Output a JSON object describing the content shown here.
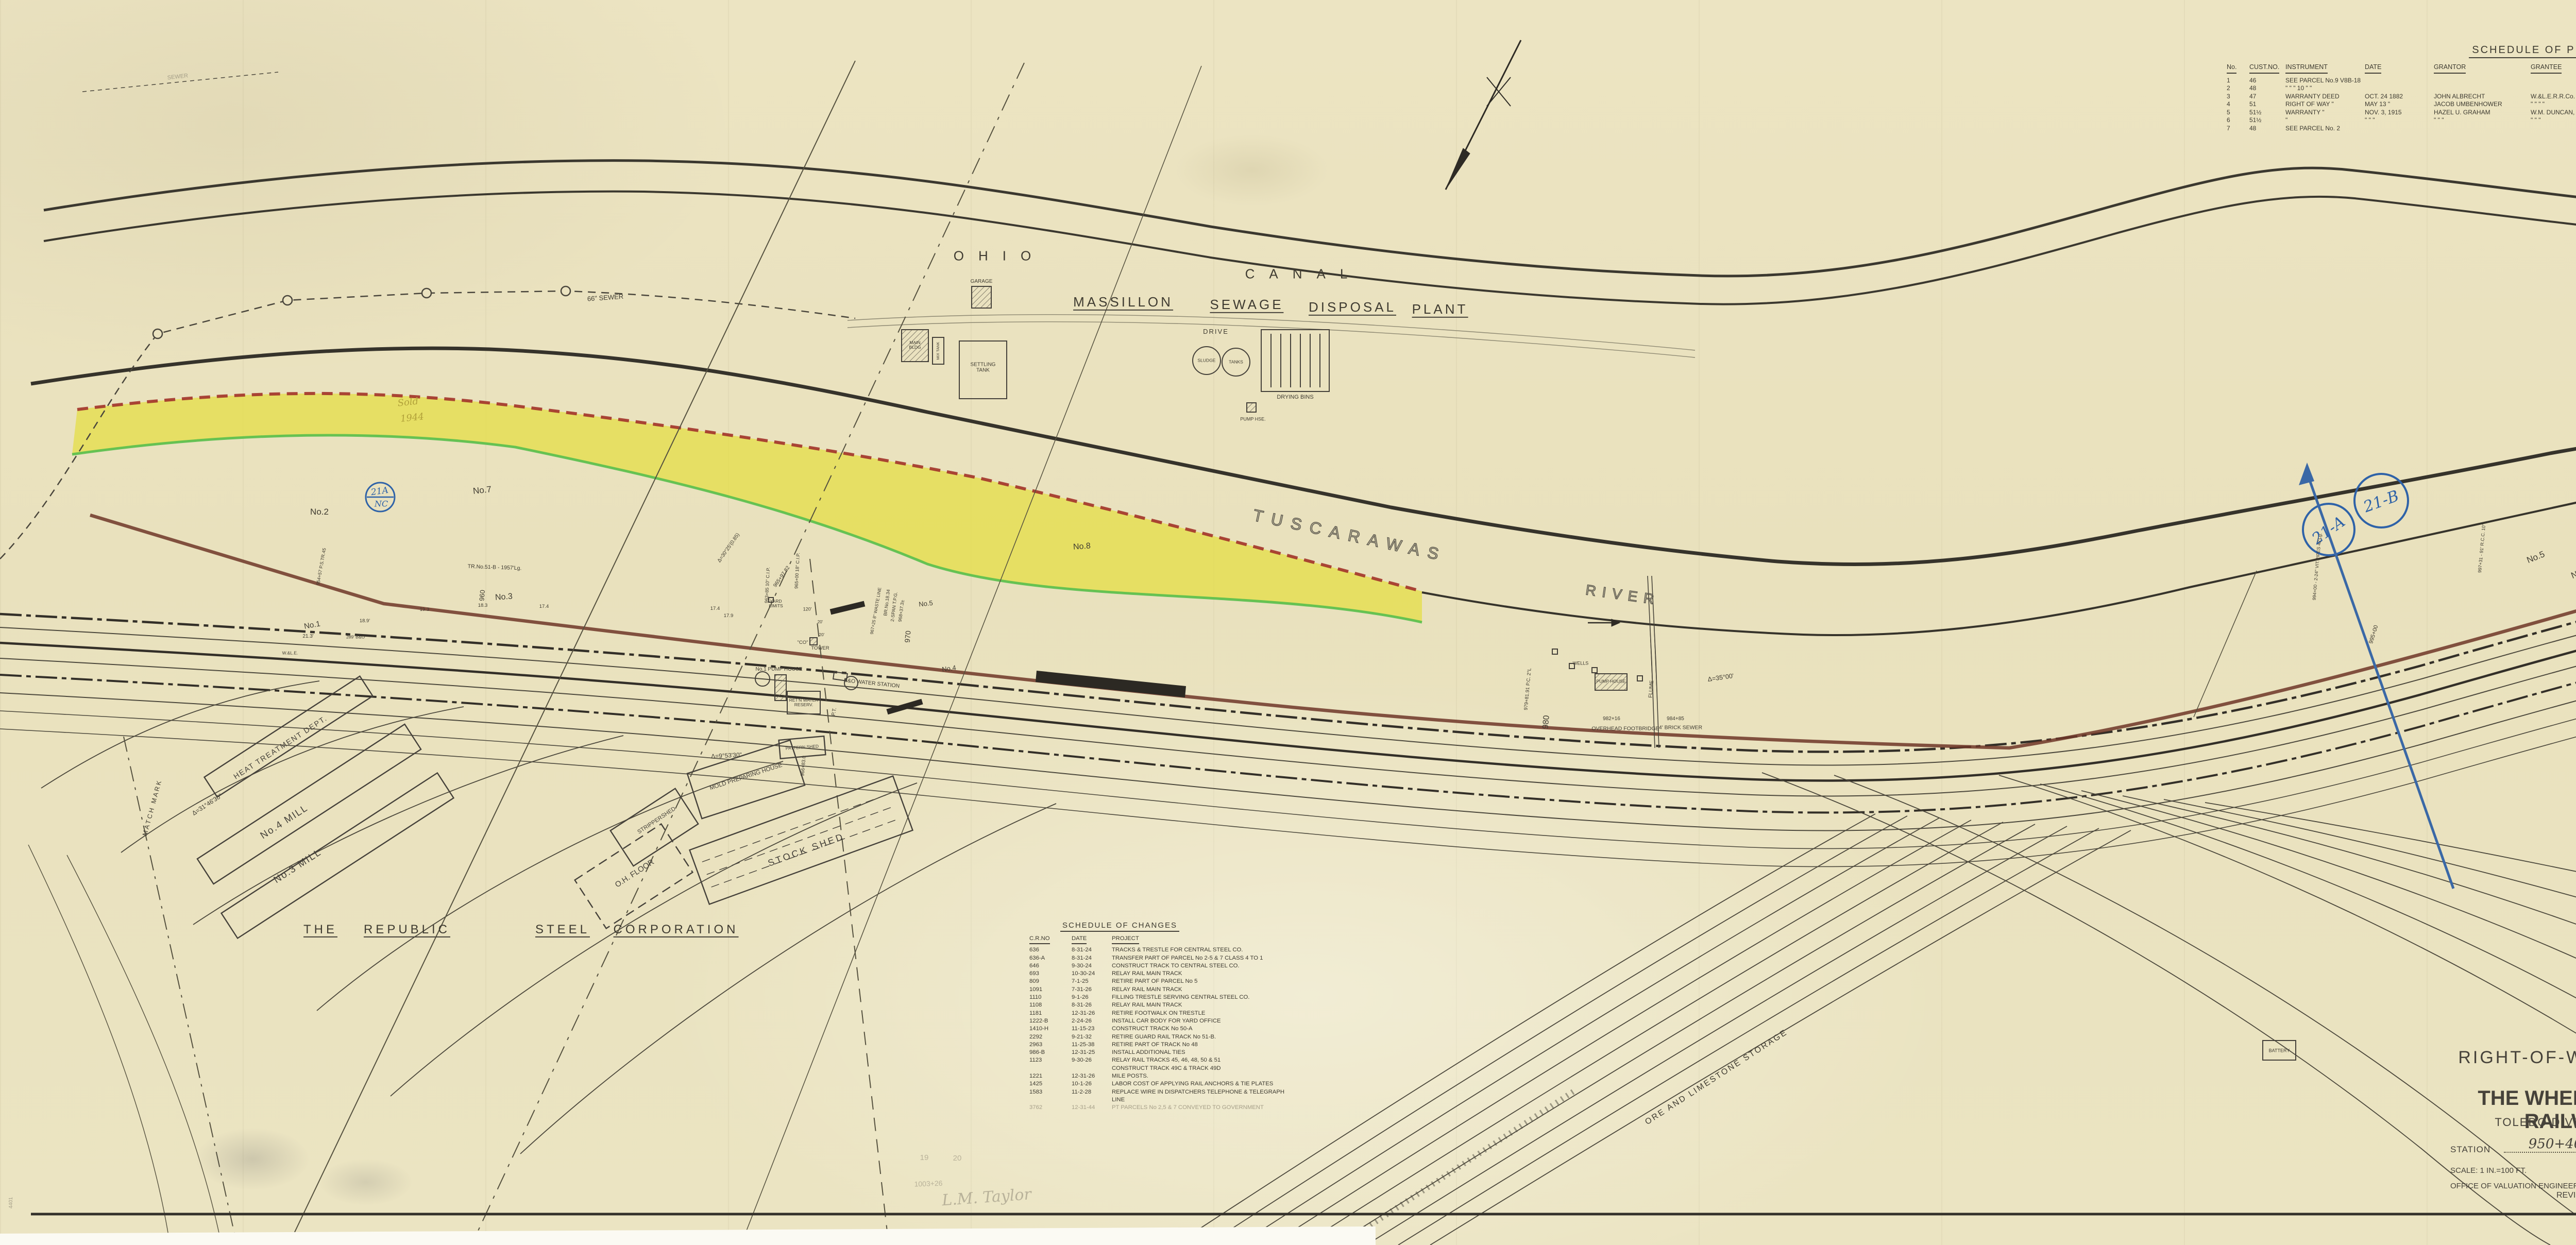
{
  "title_block": {
    "map_type": "RIGHT-OF-WAY AND TRACK MAP",
    "company": "THE WHEELING & LAKE ERIE RAILWAY COMPANY",
    "division": "TOLEDO DIVISION - MASSILLON BRANCH",
    "station_label": "STATION",
    "station_from": "950+40",
    "to_station_label": "TO STATION",
    "station_to": "1003+20",
    "scale": "SCALE:  1 IN.=100 FT.",
    "date": "JUNE 30, 1918",
    "office": "OFFICE OF VALUATION ENGINEER,",
    "office_city": "CLEVELAND, O.",
    "revised_label": "REVISED DECEMBER 31,",
    "revised_year": "1940",
    "revised_ditto": "\"",
    "revised_year2": "1941",
    "revision_note": "Rev 4/1954",
    "stamp_top": "V.8B",
    "stamp_bottom": "19"
  },
  "property_schedule": {
    "title": "SCHEDULE OF PROPERTY",
    "headers": [
      "No.",
      "CUST.NO.",
      "INSTRUMENT",
      "DATE",
      "GRANTOR",
      "GRANTEE",
      "RECORD",
      "REMARKS"
    ],
    "rows": [
      {
        "no": "1",
        "cust": "46",
        "instrument": "SEE PARCEL No.9  V8B-18",
        "date": "",
        "grantor": "",
        "grantee": "",
        "record": "",
        "remarks": ""
      },
      {
        "no": "2",
        "cust": "48",
        "instrument": "\"    \"    \" 10   \"    \"",
        "date": "",
        "grantor": "",
        "grantee": "",
        "record": "",
        "remarks": ""
      },
      {
        "no": "3",
        "cust": "47",
        "instrument": "WARRANTY DEED",
        "date": "OCT. 24 1882",
        "grantor": "JOHN ALBRECHT",
        "grantee": "W.&L.E.R.R.Co.",
        "record": "D.B.183, P.362 JAN.13, 1883",
        "remarks": ""
      },
      {
        "no": "4",
        "cust": "51",
        "instrument": "RIGHT OF WAY  \"",
        "date": "MAY 13  \"",
        "grantor": "JACOB UMBENHOWER",
        "grantee": "\"   \"   \"   \"",
        "record": "\"  \"  \" 369  \" 15  \"",
        "remarks": ""
      },
      {
        "no": "5",
        "cust": "51½",
        "instrument": "WARRANTY  \"",
        "date": "NOV. 3, 1915",
        "grantor": "HAZEL U. GRAHAM",
        "grantee": "W.M. DUNCAN, RECEIVER",
        "record": "\" 586 \" 335 NOV. 22 1915",
        "remarks": "NOT IN USE  PT. CONV'Y'D TO U.S. GOV'T"
      },
      {
        "no": "6",
        "cust": "51½",
        "instrument": "\"",
        "date": "\"   \"   \"",
        "grantor": "\"   \"   \"",
        "grantee": "\"   \"   \"",
        "record": "\"  \"  \"  \"  \"  \"",
        "remarks": "\"  \"  \""
      },
      {
        "no": "7",
        "cust": "48",
        "instrument": "SEE PARCEL No. 2",
        "date": "",
        "grantor": "",
        "grantee": "",
        "record": "",
        "remarks": ""
      }
    ]
  },
  "changes_schedule": {
    "title": "SCHEDULE OF CHANGES",
    "headers": [
      "C.R.NO",
      "DATE",
      "PROJECT"
    ],
    "rows": [
      {
        "cr": "636",
        "date": "8-31-24",
        "project": "TRACKS & TRESTLE FOR CENTRAL STEEL CO."
      },
      {
        "cr": "636-A",
        "date": "8-31-24",
        "project": "TRANSFER PART OF PARCEL No 2-5 & 7 CLASS 4 TO 1"
      },
      {
        "cr": "646",
        "date": "9-30-24",
        "project": "CONSTRUCT TRACK TO CENTRAL STEEL CO."
      },
      {
        "cr": "693",
        "date": "10-30-24",
        "project": "RELAY RAIL MAIN TRACK"
      },
      {
        "cr": "809",
        "date": "7-1-25",
        "project": "RETIRE PART OF PARCEL No 5"
      },
      {
        "cr": "1091",
        "date": "7-31-26",
        "project": "RELAY RAIL MAIN TRACK"
      },
      {
        "cr": "1110",
        "date": "9-1-26",
        "project": "FILLING TRESTLE SERVING CENTRAL STEEL CO."
      },
      {
        "cr": "1108",
        "date": "8-31-26",
        "project": "RELAY RAIL MAIN TRACK"
      },
      {
        "cr": "1181",
        "date": "12-31-26",
        "project": "RETIRE FOOTWALK ON TRESTLE"
      },
      {
        "cr": "1222-B",
        "date": "2-24-26",
        "project": "INSTALL CAR BODY FOR YARD OFFICE"
      },
      {
        "cr": "1410-H",
        "date": "11-15-23",
        "project": "CONSTRUCT TRACK No 50-A"
      },
      {
        "cr": "2292",
        "date": "9-21-32",
        "project": "RETIRE GUARD RAIL TRACK No 51-B."
      },
      {
        "cr": "2963",
        "date": "11-25-38",
        "project": "RETIRE PART OF TRACK No 48"
      },
      {
        "cr": "986-B",
        "date": "12-31-25",
        "project": "INSTALL ADDITIONAL TIES"
      },
      {
        "cr": "1123",
        "date": "9-30-26",
        "project": "RELAY RAIL TRACKS 45, 46, 48, 50 & 51"
      },
      {
        "cr": "",
        "date": "",
        "project": "CONSTRUCT TRACK 49C & TRACK 49D"
      },
      {
        "cr": "1221",
        "date": "12-31-26",
        "project": "MILE POSTS."
      },
      {
        "cr": "1425",
        "date": "10-1-26",
        "project": "LABOR COST OF APPLYING RAIL ANCHORS & TIE PLATES"
      },
      {
        "cr": "1583",
        "date": "11-2-28",
        "project": "REPLACE WIRE IN DISPATCHERS TELEPHONE & TELEGRAPH LINE"
      },
      {
        "cr": "3762",
        "date": "12-31-44",
        "project": "PT PARCELS No 2,5 & 7 CONVEYED TO GOVERNMENT"
      }
    ]
  },
  "map": {
    "ohio": "OHIO",
    "canal": "CANAL",
    "msp1": "MASSILLON",
    "msp2": "SEWAGE",
    "msp3": "DISPOSAL",
    "msp4": "PLANT",
    "drive": "DRIVE",
    "sewer66": "66\" SEWER",
    "sewer_small": "SEWER",
    "garage": "GARAGE",
    "main_bldg": "MAIN BLDG",
    "mix_tank": "MIX TANK",
    "settling_tank": "SETTLING TANK",
    "sludge": "SLUDGE",
    "tanks": "TANKS",
    "drying_bins": "DRYING BINS",
    "pump_hse": "PUMP HSE.",
    "wells": "WELLS",
    "pump_house": "PUMP HOUSE",
    "flume": "FLUME",
    "footbridge_sta": "982+16",
    "footbridge": "OVERHEAD FOOTBRIDGE",
    "brick_sewer_sta": "984+85",
    "brick_sewer": "4' BRICK SEWER",
    "sta980": "980",
    "pc979": "979+81.91  P.C. 2°L",
    "delta35": "Δ=35°00'",
    "tuscarawas": "TUSCARAWAS",
    "river": "RIVER",
    "sold1": "Sold",
    "sold2": "1944",
    "no1": "No.1",
    "no2": "No.2",
    "no3": "No.3",
    "no7": "No.7",
    "no8": "No.8",
    "no4r": "No.4",
    "no5r": "No.5",
    "no6r": "No.6",
    "no4l": "No.4",
    "no5l": "No.5",
    "tr51b": "TR.No.51-B - 1957'Lg.",
    "m213": "21.3'",
    "m189": "18.9'",
    "m193": "19.3",
    "m183": "18.3",
    "m174a": "17.4",
    "m174b": "17.4",
    "m179": "17.9",
    "sta954": "954+57  P.S.TR.45",
    "b289": "289' B&O",
    "wle": "W.&L.E.",
    "sta960": "960",
    "yard_limits": "YARD LIMITS",
    "co": "\"CO\"",
    "tower": "TOWER",
    "f120": "120'",
    "f20a": "20'",
    "f20b": "20'",
    "pump1": "No.1 PUMP HOUSE",
    "retn": "RET'N WATER RESERV.",
    "bo_water": "B&O WATER STATION",
    "br1834a": "BR.No.18.34",
    "br1834b": "2-SPAN T.P.G.",
    "br1834c": "968+37.3±",
    "sta970": "970",
    "cip963": "963+85  10\" C.I.P.",
    "cip965": "965+00  18\" C.I.P.",
    "sta96597": "965+97.82",
    "delta3025": "Δ=30°25'(0.85)",
    "waste967": "967+25  8\" WASTE LINE",
    "pt": "P.T.",
    "delta953": "Δ=9°53'30\"",
    "sta96683": "966+83.0",
    "delta3146": "Δ=31°46'30\"",
    "match_mark": "MATCH MARK",
    "heat_dept": "HEAT TREATMENT DEPT.",
    "mill4": "No.4 MILL",
    "mill3": "No.3 MILL",
    "stripper1": "STRIPPER",
    "stripper2": "SHED",
    "ohfloor": "O.H. FLOOR",
    "mold_house": "MOLD PREPARING HOUSE",
    "pattern_shed": "PATTERN SHED",
    "stock_shed": "STOCK SHED",
    "rep1": "THE",
    "rep2": "REPUBLIC",
    "rep3": "STEEL",
    "rep4": "CORPORATION",
    "ore": "ORE AND LIMESTONE STORAGE",
    "battery": "BATTERY",
    "stamp21a_nc1": "21A",
    "stamp21a_nc2": "NC",
    "stamp21a": "21-A",
    "stamp21b": "21-B",
    "stamp21bnc1": "21-B",
    "stamp21bnc2": "NC",
    "blue_sta": "995+00",
    "vit_pipes": "994+00 - 2-24\" VIT.PIPES 42'Lg.",
    "rcc_pipe": "997+31 - 91' R.C.C. 10\"L",
    "tr_no1": "TR.No.1 - 5280'Lg.±",
    "sta1000": "1000",
    "pencil1": "19",
    "pencil2": "20",
    "pencil3": "1003+26",
    "signature": "L.M. Taylor",
    "corner": "4401"
  }
}
